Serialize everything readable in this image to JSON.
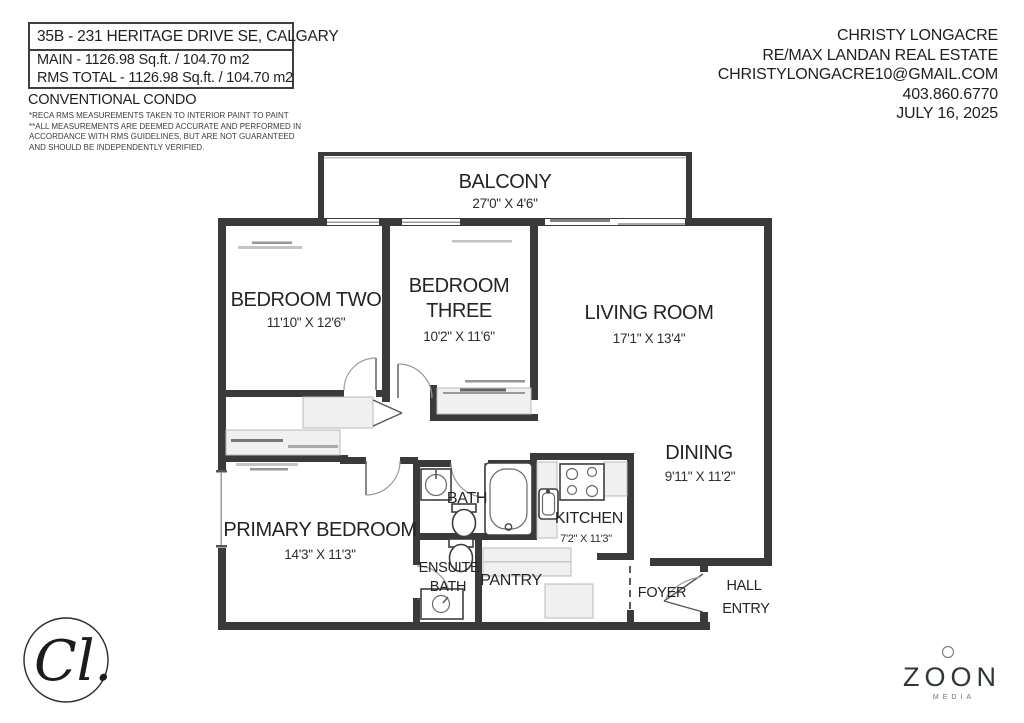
{
  "listing": {
    "title": "35B - 231 HERITAGE DRIVE SE, CALGARY",
    "main_area": "MAIN - 1126.98 Sq.ft. / 104.70 m2",
    "rms_total": "RMS TOTAL - 1126.98 Sq.ft. / 104.70 m2",
    "property_type": "CONVENTIONAL CONDO",
    "disclaimer": [
      "*RECA RMS MEASUREMENTS TAKEN TO INTERIOR PAINT TO PAINT",
      "**ALL MEASUREMENTS ARE DEEMED ACCURATE AND PERFORMED IN",
      "ACCORDANCE WITH RMS GUIDELINES, BUT ARE NOT GUARANTEED",
      "AND SHOULD BE INDEPENDENTLY VERIFIED."
    ]
  },
  "agent": {
    "name": "CHRISTY LONGACRE",
    "brokerage": "RE/MAX LANDAN REAL ESTATE",
    "email": "CHRISTYLONGACRE10@GMAIL.COM",
    "phone": "403.860.6770",
    "date": "JULY 16, 2025"
  },
  "rooms": {
    "balcony": {
      "label": "BALCONY",
      "dim": "27'0\" X 4'6\""
    },
    "bedroom_two": {
      "label": "BEDROOM TWO",
      "dim": "11'10\" X 12'6\""
    },
    "bedroom_three": {
      "label1": "BEDROOM",
      "label2": "THREE",
      "dim": "10'2\" X 11'6\""
    },
    "living_room": {
      "label": "LIVING ROOM",
      "dim": "17'1\" X 13'4\""
    },
    "dining": {
      "label": "DINING",
      "dim": "9'11\" X 11'2\""
    },
    "primary_bedroom": {
      "label": "PRIMARY BEDROOM",
      "dim": "14'3\" X 11'3\""
    },
    "kitchen": {
      "label": "KITCHEN",
      "dim": "7'2\" X 11'3\""
    },
    "bath": {
      "label": "BATH"
    },
    "ensuite_bath": {
      "label1": "ENSUITE",
      "label2": "BATH"
    },
    "pantry": {
      "label": "PANTRY"
    },
    "foyer": {
      "label": "FOYER"
    },
    "hall_entry": {
      "label1": "HALL",
      "label2": "ENTRY"
    }
  },
  "branding": {
    "agent_monogram": "Cl.",
    "media_logo": "ZOON",
    "media_sub": "MEDIA"
  },
  "colors": {
    "wall": "#3a3a3a",
    "text": "#1f1f1f",
    "closet_fill": "#f0f0f0"
  }
}
